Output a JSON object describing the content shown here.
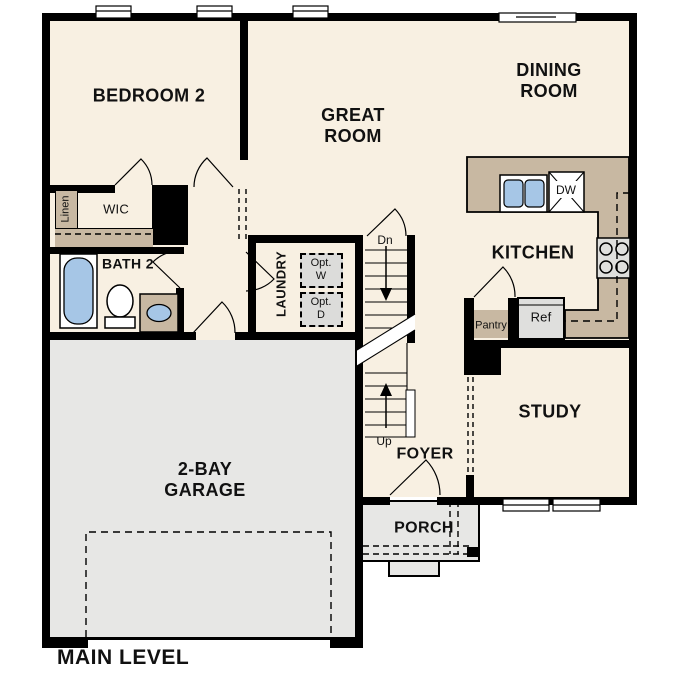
{
  "title": "MAIN LEVEL",
  "colors": {
    "background": "#ffffff",
    "wall": "#000000",
    "floor": "#f8f0e2",
    "garage": "#e7e7e5",
    "counter": "#c8b8a2",
    "fixture_blue": "#a6c6e6",
    "appliance": "#dfdfdd",
    "optional_box": "#dcdcda"
  },
  "labels": {
    "bedroom2": "BEDROOM 2",
    "great_room": "GREAT\nROOM",
    "dining_room": "DINING\nROOM",
    "kitchen": "KITCHEN",
    "study": "STUDY",
    "garage": "2-BAY\nGARAGE",
    "foyer": "FOYER",
    "porch": "PORCH",
    "bath2": "BATH 2",
    "wic": "WIC",
    "linen": "Linen",
    "laundry": "LAUNDRY",
    "opt_washer": "Opt.\nW",
    "opt_dryer": "Opt.\nD",
    "pantry": "Pantry",
    "refrigerator": "Ref",
    "dishwasher": "DW",
    "stairs_down": "Dn",
    "stairs_up": "Up"
  }
}
